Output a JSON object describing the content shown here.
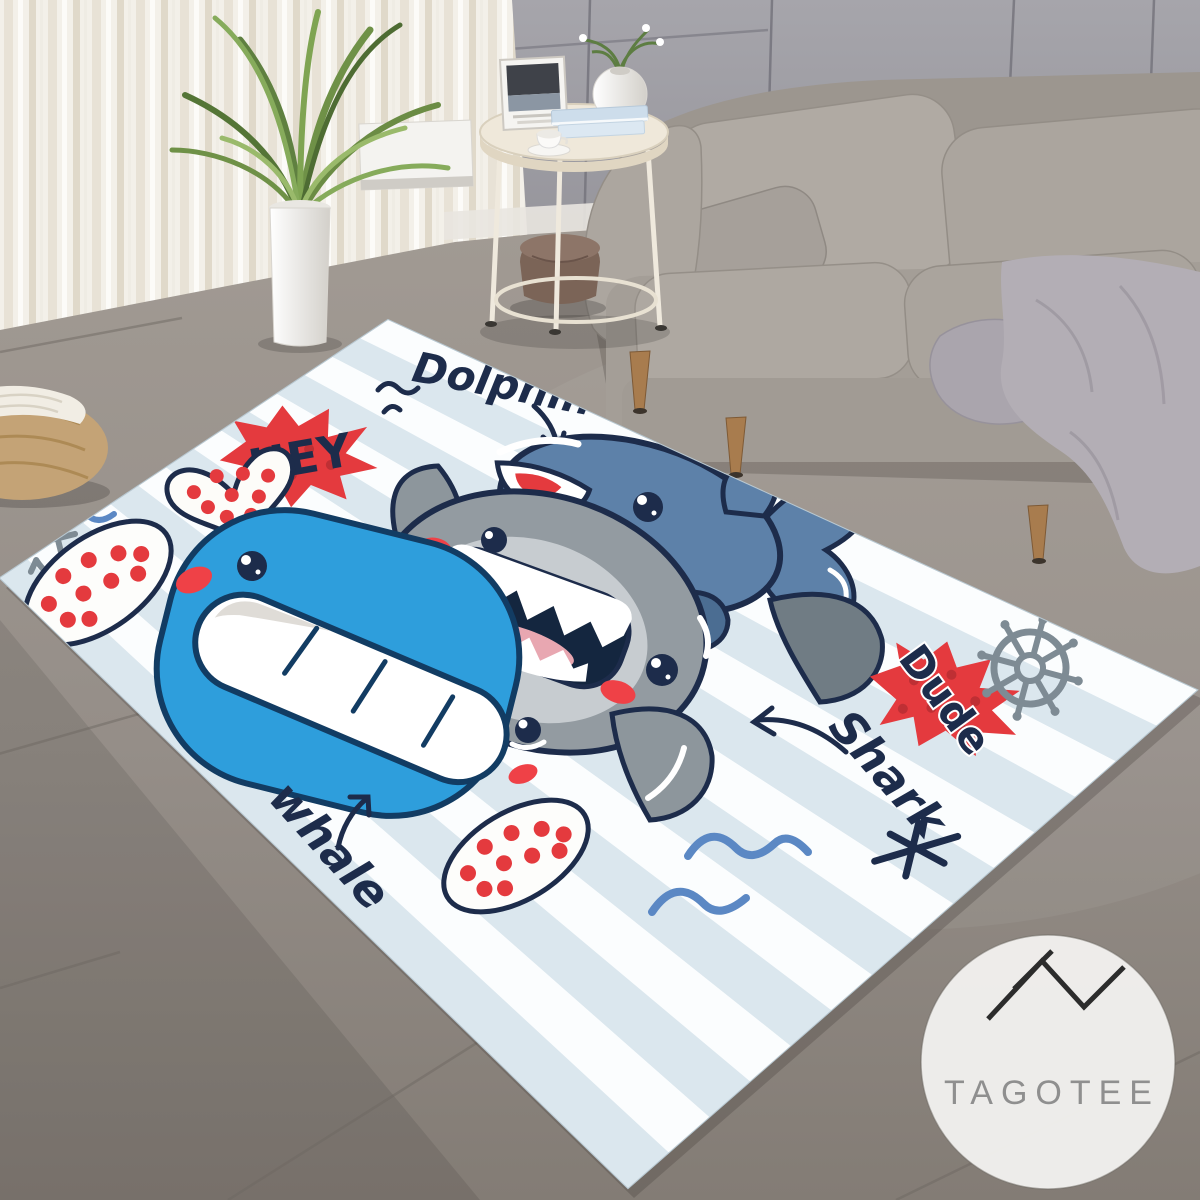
{
  "watermark": {
    "brand": "TAGOTEE"
  },
  "rug": {
    "labels": {
      "hey": "HEY",
      "dolphin": "Dolphin",
      "shark": "Shark",
      "whale": "whale",
      "dude": "Dude"
    }
  },
  "colors": {
    "navy": "#1d2c4b",
    "red": "#e43a3e",
    "red_dark": "#bf2f34",
    "rug_blue": "#dbe7ee",
    "rug_white": "#fbfdfe",
    "whale_blue": "#2e9edc",
    "shark_gray": "#939ba1",
    "shark_face": "#c7ccd0",
    "dolphin_blue": "#5d81a9",
    "doodle_gray": "#7e8b94",
    "wave_blue": "#5b88c4",
    "wall_gray": "#9b9aa0",
    "floor_gray": "#948d87",
    "sofa_gray": "#a7a19a",
    "curtain_cream": "#f3f0e9",
    "wood_brown": "#a87c4e",
    "logo_ink": "#2c2c2c",
    "logo_text": "#8f8f8f",
    "logo_bg": "#f2f1ef"
  }
}
